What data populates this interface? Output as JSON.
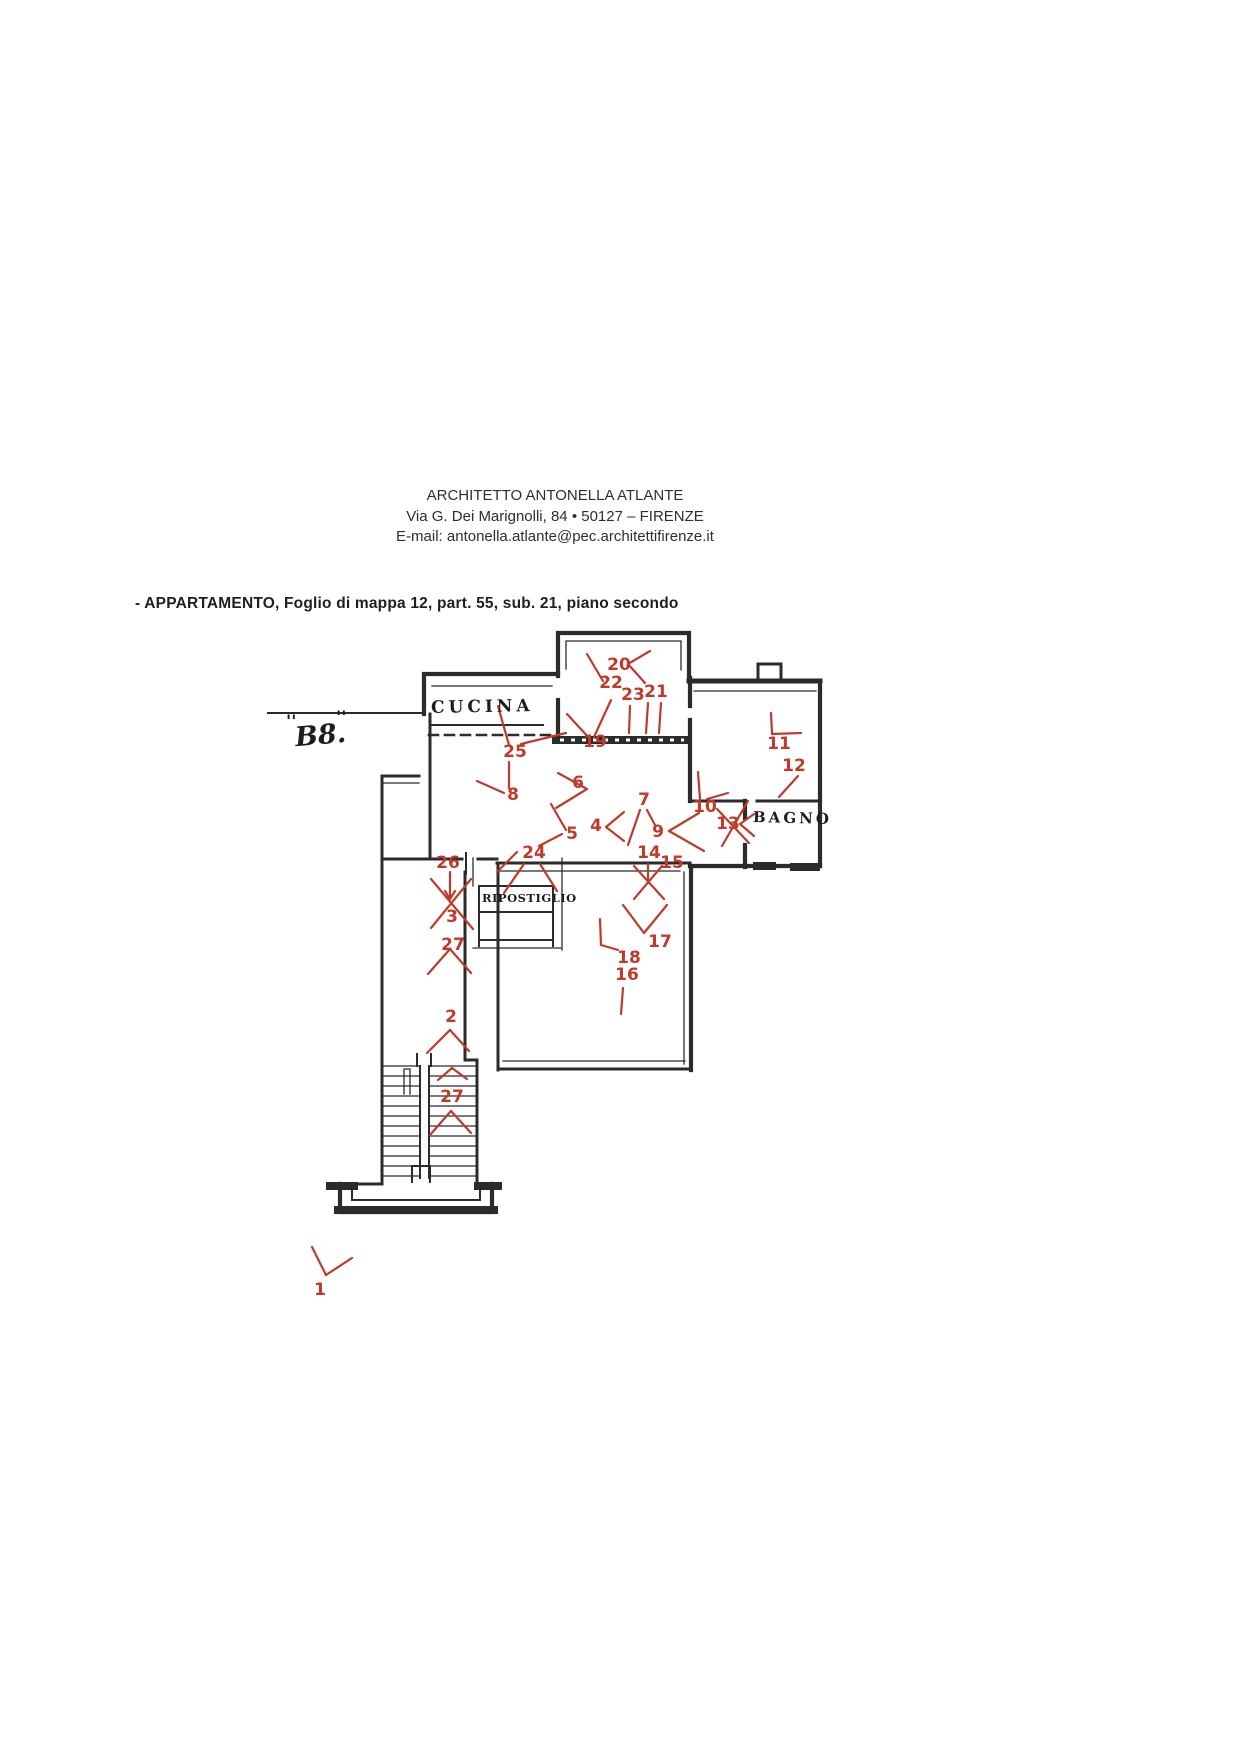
{
  "header": {
    "line1": "ARCHITETTO ANTONELLA ATLANTE",
    "line2": "Via G. Dei Marignolli, 84 • 50127 – FIRENZE",
    "line3": "E-mail: antonella.atlante@pec.architettifirenze.it"
  },
  "title": "- APPARTAMENTO, Foglio di mappa 12, part. 55, sub. 21, piano secondo",
  "colors": {
    "marker_red": "#bf3a2b",
    "ink": "#2b2b2b",
    "paper": "#ffffff"
  },
  "plan": {
    "room_labels": [
      {
        "text": "CUCINA"
      },
      {
        "text": "B8."
      },
      {
        "text": "RIPOSTIGLIO"
      },
      {
        "text": "BAGNO"
      }
    ],
    "b8_tick_left": "''",
    "b8_tick_right": "''",
    "markers": [
      {
        "n": "1",
        "x": 320,
        "y": 1295,
        "lines": [
          [
            312,
            1247,
            326,
            1275
          ],
          [
            326,
            1275,
            352,
            1258
          ]
        ]
      },
      {
        "n": "2",
        "x": 451,
        "y": 1022,
        "lines": [
          [
            450,
            1030,
            427,
            1053
          ],
          [
            450,
            1030,
            469,
            1051
          ]
        ]
      },
      {
        "n": "3",
        "x": 452,
        "y": 922,
        "lines": [
          [
            431,
            879,
            473,
            929
          ],
          [
            471,
            879,
            431,
            928
          ]
        ]
      },
      {
        "n": "27",
        "x": 453,
        "y": 950,
        "lines": [
          [
            428,
            974,
            450,
            949
          ],
          [
            450,
            949,
            471,
            973
          ]
        ]
      },
      {
        "n": "26",
        "x": 448,
        "y": 868,
        "lines": [
          [
            450,
            872,
            450,
            899
          ],
          [
            450,
            899,
            445,
            891
          ],
          [
            450,
            899,
            455,
            891
          ]
        ]
      },
      {
        "n": "24",
        "x": 534,
        "y": 858,
        "lines": [
          [
            524,
            864,
            504,
            893
          ],
          [
            540,
            864,
            557,
            891
          ],
          [
            517,
            852,
            497,
            872
          ]
        ]
      },
      {
        "n": "25",
        "x": 515,
        "y": 757,
        "lines": [
          [
            509,
            745,
            498,
            706
          ],
          [
            521,
            744,
            566,
            733
          ],
          [
            509,
            762,
            509,
            788
          ]
        ]
      },
      {
        "n": "8",
        "x": 513,
        "y": 800,
        "lines": [
          [
            504,
            793,
            477,
            781
          ]
        ]
      },
      {
        "n": "6",
        "x": 578,
        "y": 788,
        "lines": [
          [
            558,
            773,
            587,
            789
          ],
          [
            587,
            789,
            556,
            808
          ]
        ]
      },
      {
        "n": "5",
        "x": 572,
        "y": 839,
        "lines": [
          [
            562,
            834,
            539,
            846
          ],
          [
            551,
            804,
            566,
            830
          ]
        ]
      },
      {
        "n": "4",
        "x": 596,
        "y": 831,
        "lines": [
          [
            606,
            827,
            624,
            812
          ],
          [
            606,
            827,
            624,
            841
          ]
        ]
      },
      {
        "n": "7",
        "x": 644,
        "y": 805,
        "lines": [
          [
            640,
            810,
            628,
            845
          ],
          [
            647,
            810,
            655,
            825
          ]
        ]
      },
      {
        "n": "9",
        "x": 658,
        "y": 837,
        "lines": [
          [
            669,
            831,
            699,
            813
          ],
          [
            669,
            831,
            704,
            851
          ]
        ]
      },
      {
        "n": "10",
        "x": 705,
        "y": 812,
        "lines": [
          [
            698,
            772,
            700,
            799
          ],
          [
            707,
            799,
            728,
            793
          ]
        ]
      },
      {
        "n": "13",
        "x": 728,
        "y": 829,
        "lines": [
          [
            740,
            824,
            754,
            814
          ],
          [
            740,
            824,
            754,
            836
          ],
          [
            748,
            801,
            722,
            846
          ],
          [
            717,
            809,
            749,
            843
          ]
        ]
      },
      {
        "n": "14",
        "x": 649,
        "y": 858,
        "lines": [
          [
            648,
            864,
            648,
            882
          ]
        ]
      },
      {
        "n": "15",
        "x": 672,
        "y": 868,
        "lines": [
          [
            634,
            866,
            664,
            899
          ],
          [
            662,
            866,
            634,
            899
          ]
        ]
      },
      {
        "n": "16",
        "x": 627,
        "y": 980,
        "lines": [
          [
            623,
            988,
            621,
            1014
          ]
        ]
      },
      {
        "n": "17",
        "x": 660,
        "y": 947,
        "lines": [
          [
            623,
            905,
            644,
            933
          ],
          [
            644,
            933,
            667,
            905
          ]
        ]
      },
      {
        "n": "18",
        "x": 629,
        "y": 963,
        "lines": [
          [
            600,
            919,
            601,
            945
          ],
          [
            601,
            945,
            618,
            950
          ]
        ]
      },
      {
        "n": "19",
        "x": 595,
        "y": 747,
        "s": 18,
        "lines": [
          [
            567,
            714,
            590,
            739
          ],
          [
            611,
            700,
            594,
            737
          ]
        ]
      },
      {
        "n": "20",
        "x": 619,
        "y": 670,
        "lines": [
          [
            628,
            664,
            650,
            651
          ],
          [
            628,
            664,
            645,
            683
          ],
          [
            587,
            654,
            603,
            681
          ]
        ]
      },
      {
        "n": "22",
        "x": 611,
        "y": 688,
        "s": 20,
        "lines": []
      },
      {
        "n": "23",
        "x": 633,
        "y": 700,
        "lines": [
          [
            630,
            706,
            629,
            733
          ]
        ]
      },
      {
        "n": "21",
        "x": 656,
        "y": 697,
        "s": 18,
        "lines": [
          [
            648,
            703,
            646,
            733
          ],
          [
            661,
            703,
            659,
            733
          ]
        ]
      },
      {
        "n": "11",
        "x": 779,
        "y": 749,
        "lines": [
          [
            771,
            713,
            772,
            733
          ],
          [
            772,
            734,
            801,
            733
          ]
        ]
      },
      {
        "n": "12",
        "x": 794,
        "y": 771,
        "lines": [
          [
            798,
            776,
            779,
            797
          ]
        ]
      },
      {
        "n": "27",
        "x": 452,
        "y": 1102,
        "lines": [
          [
            430,
            1135,
            451,
            1111
          ],
          [
            451,
            1111,
            471,
            1133
          ],
          [
            438,
            1080,
            452,
            1068
          ],
          [
            452,
            1068,
            467,
            1079
          ]
        ]
      }
    ]
  }
}
